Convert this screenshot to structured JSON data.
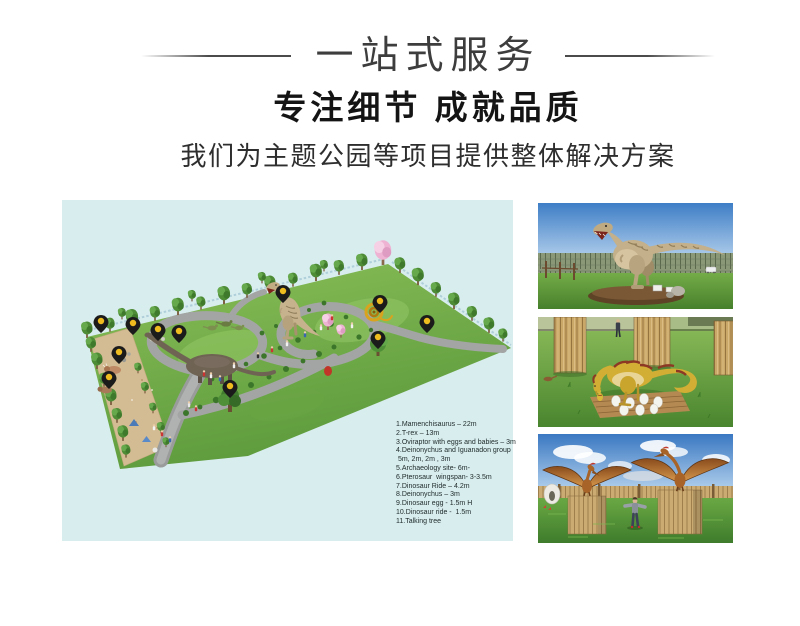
{
  "header": {
    "banner_title": "一站式服务",
    "heading": "专注细节 成就品质",
    "subheading": "我们为主题公园等项目提供整体解决方案"
  },
  "park_map": {
    "bg_color": "#d8edee",
    "pin_color_black": "#1b1b1b",
    "pin_color_yellow": "#eebc1f",
    "legend_lines": [
      "1.Mamenchisaurus – 22m",
      "2.T-rex – 13m",
      "3.Oviraptor with eggs and babies – 3m",
      "4.Deinonychus and Iguanadon group",
      " 5m, 2m, 2m , 3m",
      "5.Archaeology site- 6m-",
      "6.Pterosaur  wingspan- 3-3.5m",
      "7.Dinosaur Ride – 4.2m",
      "8.Deinonychus – 3m",
      "9.Dinosaur egg - 1.5m H",
      "10.Dinosaur ride -  1.5m",
      "11.Talking tree"
    ]
  }
}
